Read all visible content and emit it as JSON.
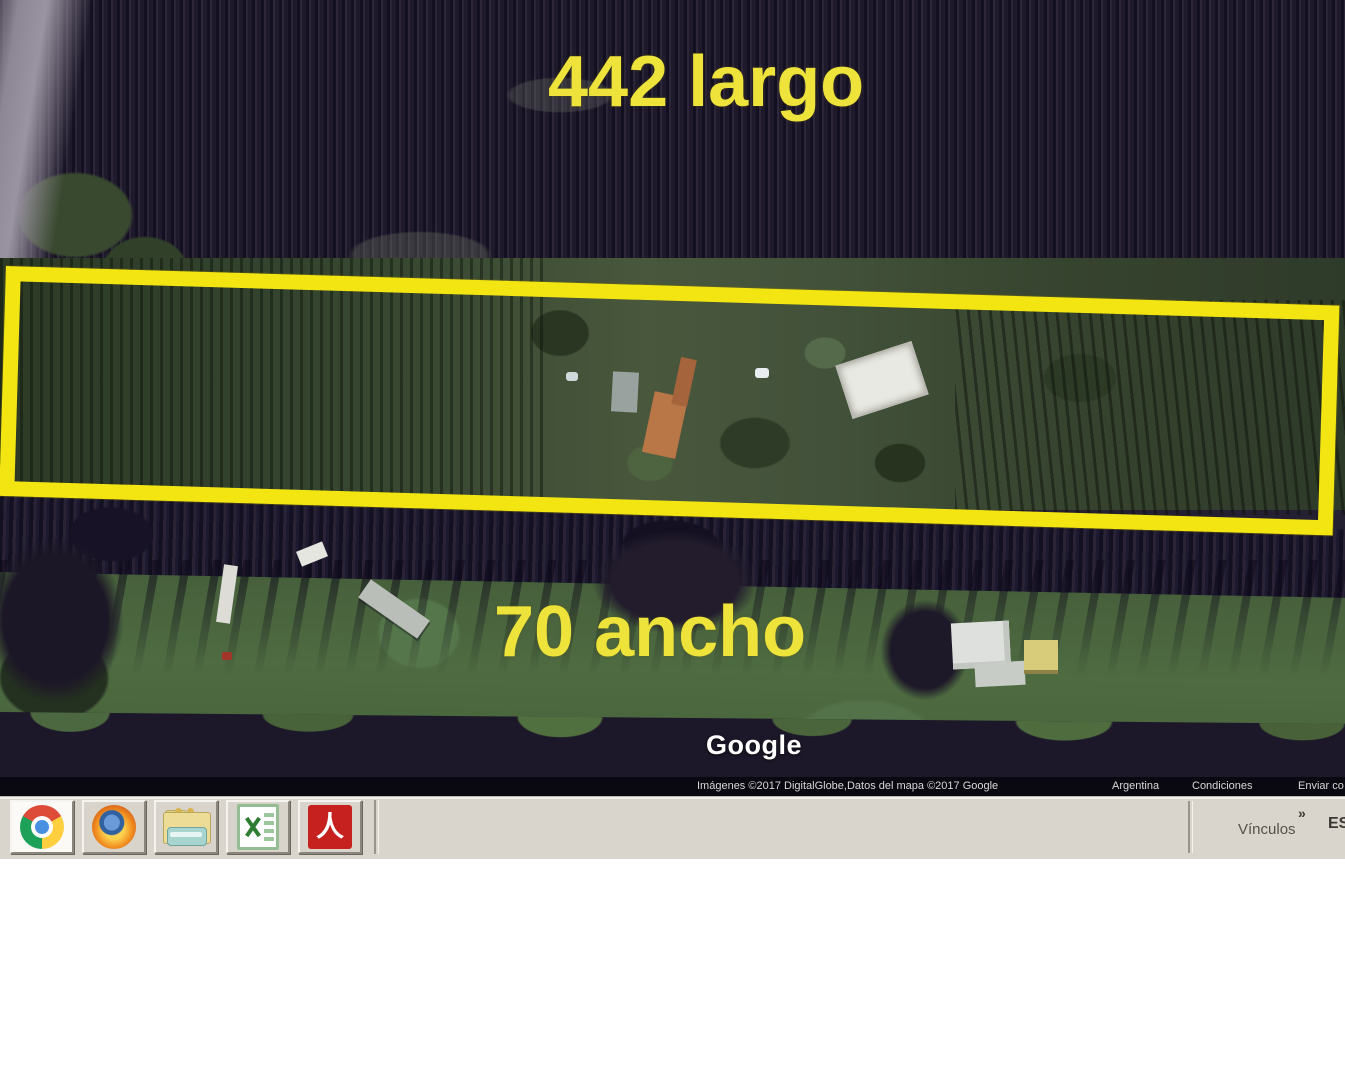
{
  "map": {
    "annotation_length": "442 largo",
    "annotation_width": "70 ancho",
    "annotation_color": "#ede33a",
    "highlight_box_color": "#f3e512",
    "watermark": "Google",
    "attribution_imagery": "Imágenes ©2017 DigitalGlobe,Datos del mapa ©2017 Google",
    "attribution_links": [
      "Argentina",
      "Condiciones",
      "Enviar co"
    ]
  },
  "taskbar": {
    "quick_launch_icons": [
      "chrome-icon",
      "firefox-icon",
      "folder-vehicle-icon",
      "excel-icon",
      "acrobat-icon"
    ],
    "active_icon": "chrome-icon",
    "links_label": "Vínculos",
    "links_chevron": "»",
    "language_indicator": "ES"
  }
}
